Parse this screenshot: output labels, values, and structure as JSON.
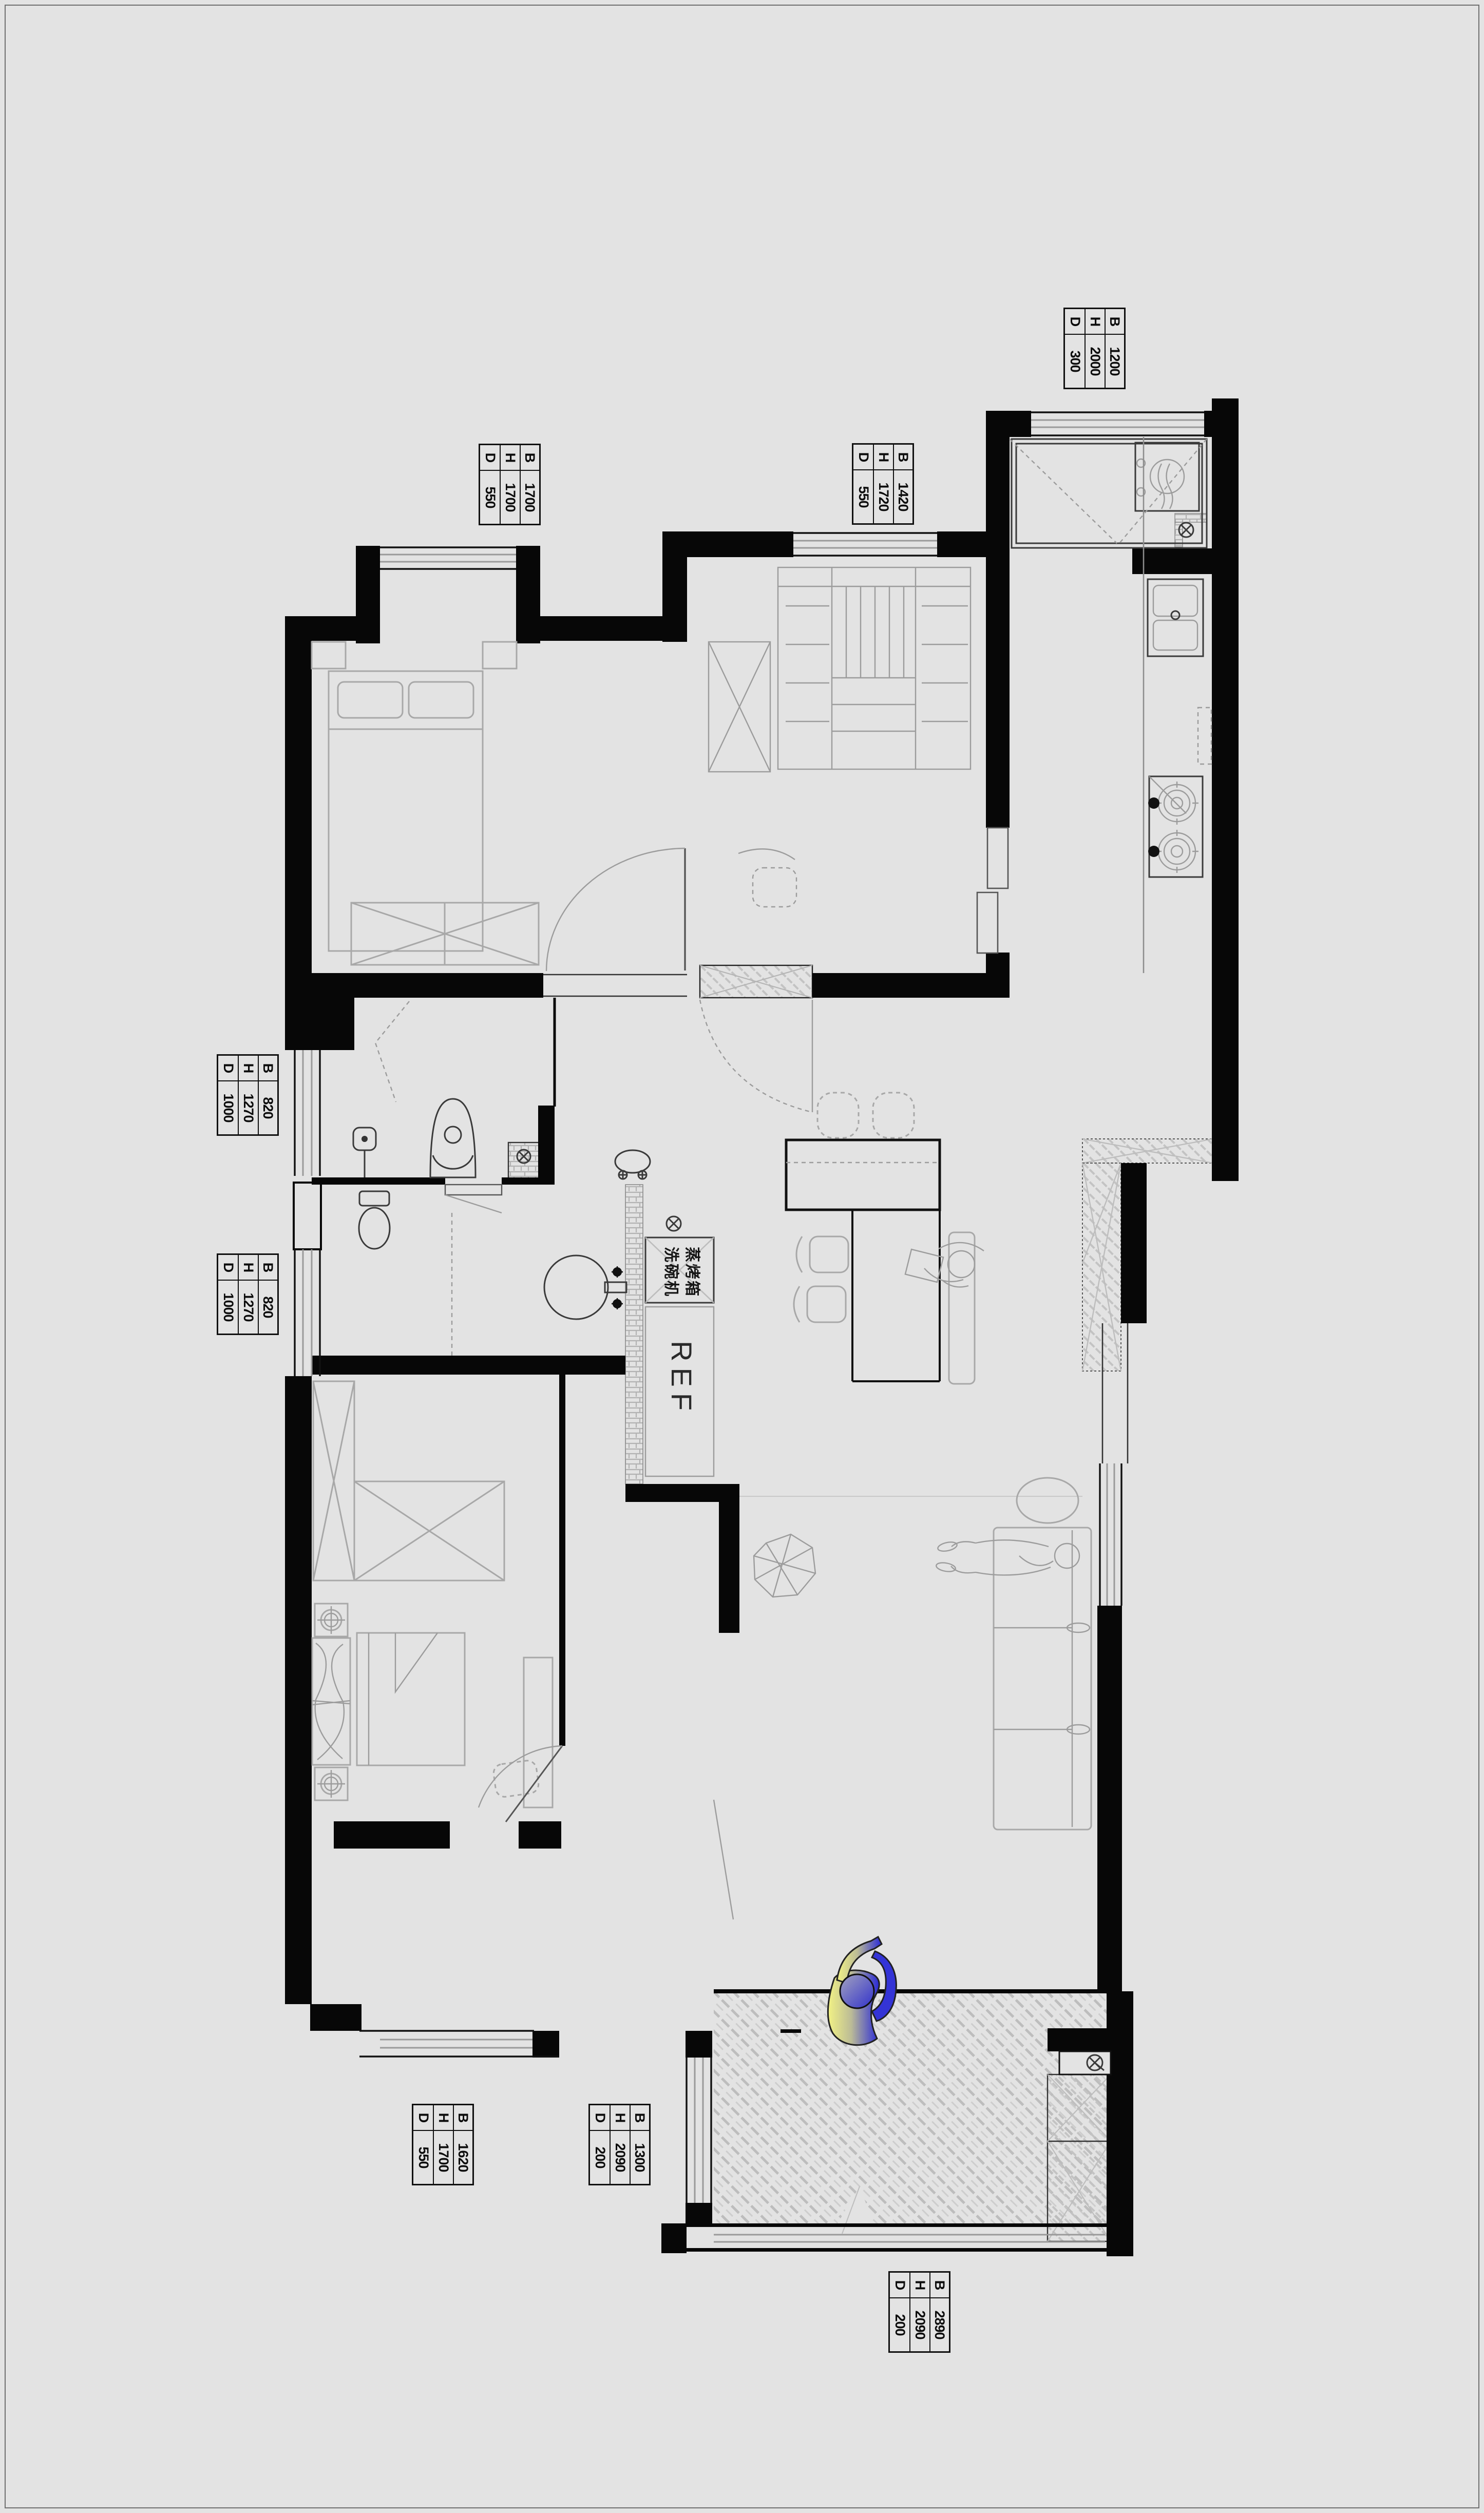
{
  "page": {
    "kind": "apartment floor plan drawing",
    "background": "#e3e3e3",
    "wall_color": "#070707",
    "sketch_color": "#a8a8a8",
    "person_gradient": [
      "#f2f284",
      "#2828d8"
    ]
  },
  "labels": [
    {
      "name": "window-top-right",
      "rows": [
        {
          "k": "B",
          "v": "1200"
        },
        {
          "k": "H",
          "v": "2000"
        },
        {
          "k": "D",
          "v": "300"
        }
      ]
    },
    {
      "name": "window-bedroom1-bay",
      "rows": [
        {
          "k": "B",
          "v": "1700"
        },
        {
          "k": "H",
          "v": "1700"
        },
        {
          "k": "D",
          "v": "550"
        }
      ]
    },
    {
      "name": "window-closet-room",
      "rows": [
        {
          "k": "B",
          "v": "1420"
        },
        {
          "k": "H",
          "v": "1720"
        },
        {
          "k": "D",
          "v": "550"
        }
      ]
    },
    {
      "name": "window-bath1-left",
      "rows": [
        {
          "k": "B",
          "v": "820"
        },
        {
          "k": "H",
          "v": "1270"
        },
        {
          "k": "D",
          "v": "1000"
        }
      ]
    },
    {
      "name": "window-bath2-left",
      "rows": [
        {
          "k": "B",
          "v": "820"
        },
        {
          "k": "H",
          "v": "1270"
        },
        {
          "k": "D",
          "v": "1000"
        }
      ]
    },
    {
      "name": "window-bedroom2-bay",
      "rows": [
        {
          "k": "B",
          "v": "1620"
        },
        {
          "k": "H",
          "v": "1700"
        },
        {
          "k": "D",
          "v": "550"
        }
      ]
    },
    {
      "name": "window-balcony-west",
      "rows": [
        {
          "k": "B",
          "v": "1300"
        },
        {
          "k": "H",
          "v": "2090"
        },
        {
          "k": "D",
          "v": "200"
        }
      ]
    },
    {
      "name": "window-balcony-south",
      "rows": [
        {
          "k": "B",
          "v": "2890"
        },
        {
          "k": "H",
          "v": "2090"
        },
        {
          "k": "D",
          "v": "200"
        }
      ]
    }
  ],
  "appliances": {
    "steam_oven": "蒸烤箱",
    "dishwasher": "洗碗机",
    "fridge": "REF"
  }
}
